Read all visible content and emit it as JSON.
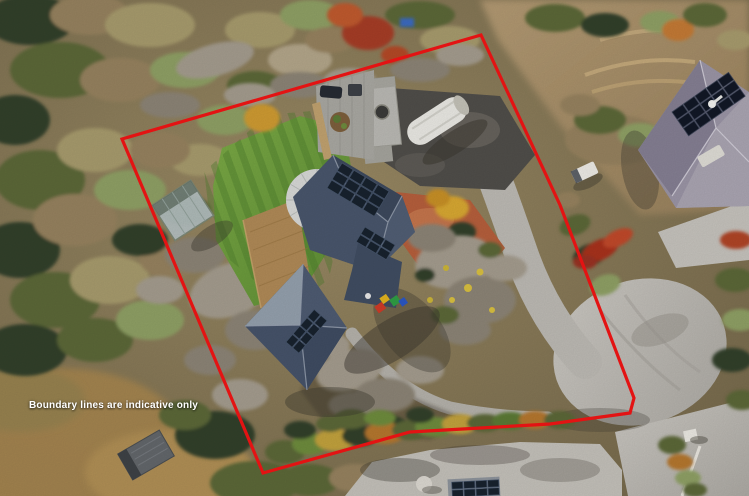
{
  "photo": {
    "kind": "aerial-drone-photograph",
    "subject": "Hillside residential property: house with solar panels, lawn terraces, rock gardens, sheds, boat, and cul-de-sac road with neighbouring houses",
    "disclaimer": "Boundary lines are indicative only"
  },
  "boundary": {
    "points": "122,139 481,35 560,205 634,398 630,413 550,424 410,432 263,473",
    "color": "#e31313",
    "stroke_width": "3.2"
  },
  "colors": {
    "disclaimer_text": "#ffffff",
    "boundary_red": "#e31313",
    "lawn_green": "#6f9e3f",
    "house_roof_slate": "#46536a",
    "solar_panel_navy": "#18222e",
    "road_grey": "#c3c0ba",
    "terracotta_paving": "#b65f3c",
    "neighbor_roof_mauve": "#9b95a6",
    "boat_cover_white": "#eae9e4"
  }
}
